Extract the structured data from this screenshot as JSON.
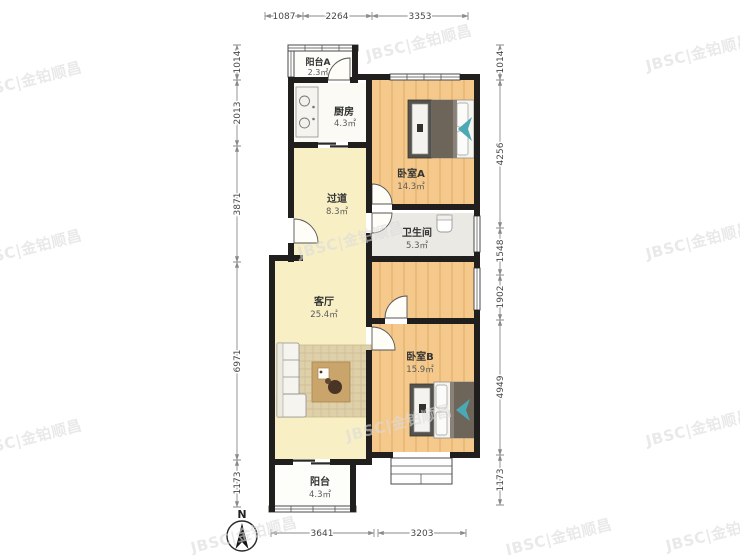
{
  "watermark": {
    "text": "JBSC|金铂顺昌",
    "rotation": -14,
    "positions": [
      [
        30,
        85
      ],
      [
        420,
        48
      ],
      [
        700,
        58
      ],
      [
        30,
        253
      ],
      [
        352,
        245
      ],
      [
        700,
        246
      ],
      [
        30,
        443
      ],
      [
        400,
        428
      ],
      [
        700,
        433
      ],
      [
        245,
        540
      ],
      [
        560,
        542
      ],
      [
        720,
        538
      ]
    ]
  },
  "north": {
    "label": "N"
  },
  "rooms": {
    "balcony_a": {
      "name": "阳台A",
      "area": "2.3㎡"
    },
    "kitchen": {
      "name": "厨房",
      "area": "4.3㎡"
    },
    "bedroom_a": {
      "name": "卧室A",
      "area": "14.3㎡"
    },
    "hallway": {
      "name": "过道",
      "area": "8.3㎡"
    },
    "bathroom": {
      "name": "卫生间",
      "area": "5.3㎡"
    },
    "living_room": {
      "name": "客厅",
      "area": "25.4㎡"
    },
    "bedroom_b": {
      "name": "卧室B",
      "area": "15.9㎡"
    },
    "balcony": {
      "name": "阳台",
      "area": "4.3㎡"
    }
  },
  "dimensions": {
    "top": [
      "1087",
      "2264",
      "3353"
    ],
    "bottom": [
      "3641",
      "3203"
    ],
    "left": [
      "1014",
      "2013",
      "3871",
      "6971",
      "1173"
    ],
    "right": [
      "1014",
      "4256",
      "1548",
      "1902",
      "4949",
      "1173"
    ]
  },
  "colors": {
    "wall": "#201f1d",
    "bedroom_floor": "#f5c98c",
    "living_floor": "#f8efc5",
    "kitchen_floor": "#fbfaf5",
    "bath_floor": "#eae9e4",
    "balcony_floor": "#fdfdfa",
    "rug": "#ded0a9",
    "table": "#c9a56b",
    "bed_blanket": "#6e655a",
    "teal_accent": "#4aa9b5",
    "dim_color": "#474747",
    "label_color": "#333333",
    "watermark_color": "#dcdcdc"
  }
}
